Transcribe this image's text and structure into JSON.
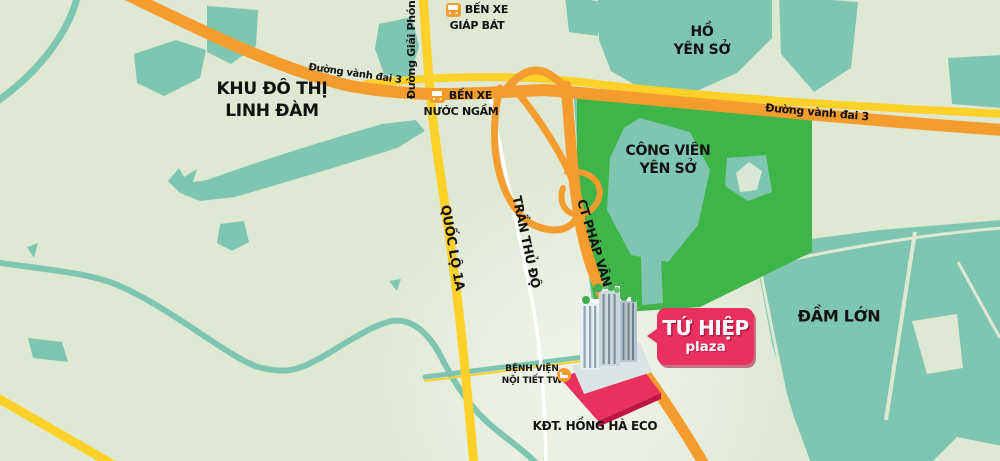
{
  "map": {
    "labels": {
      "linh_dam": {
        "line1": "KHU ĐÔ THỊ",
        "line2": "LINH ĐÀM"
      },
      "ho_yen_so": {
        "line1": "HỒ",
        "line2": "YÊN SỞ"
      },
      "cong_vien_yen_so": {
        "line1": "CÔNG VIÊN",
        "line2": "YÊN SỞ"
      },
      "dam_lon": "ĐẦM LỚN",
      "kdt_hong_ha_eco": "KĐT. HỒNG HÀ ECO"
    },
    "roads": {
      "vanh_dai_3_west": "Đường vành đai 3",
      "vanh_dai_3_east": "Đường vành đai 3",
      "giai_phong": "Đường Giải Phóng",
      "quoc_lo_1a": "QUỐC LỘ 1A",
      "tran_thu_do": "TRẦN THỦ ĐỘ",
      "ct_phap_van": "CT PHÁP VÂN"
    },
    "pois": {
      "ben_xe_giap_bat": {
        "line1": "BẾN XE",
        "line2": "GIÁP BÁT"
      },
      "ben_xe_nuoc_ngam": {
        "line1": "BẾN XE",
        "line2": "NƯỚC NGẦM"
      },
      "benh_vien": {
        "line1": "BỆNH VIỆN",
        "line2": "NỘI TIẾT TW"
      }
    },
    "badge": {
      "title": "TỨ HIỆP",
      "subtitle": "plaza"
    },
    "icons": [
      "bus-icon",
      "hospital-icon",
      "house-icon"
    ],
    "colors": {
      "background": "#dfe8d3",
      "water": "#7fc6b2",
      "park_green": "#3eb449",
      "road_yellow": "#fdd127",
      "road_orange": "#f49d2e",
      "road_white": "#ffffff",
      "badge_pink": "#e8315c",
      "label_black": "#121212"
    }
  }
}
